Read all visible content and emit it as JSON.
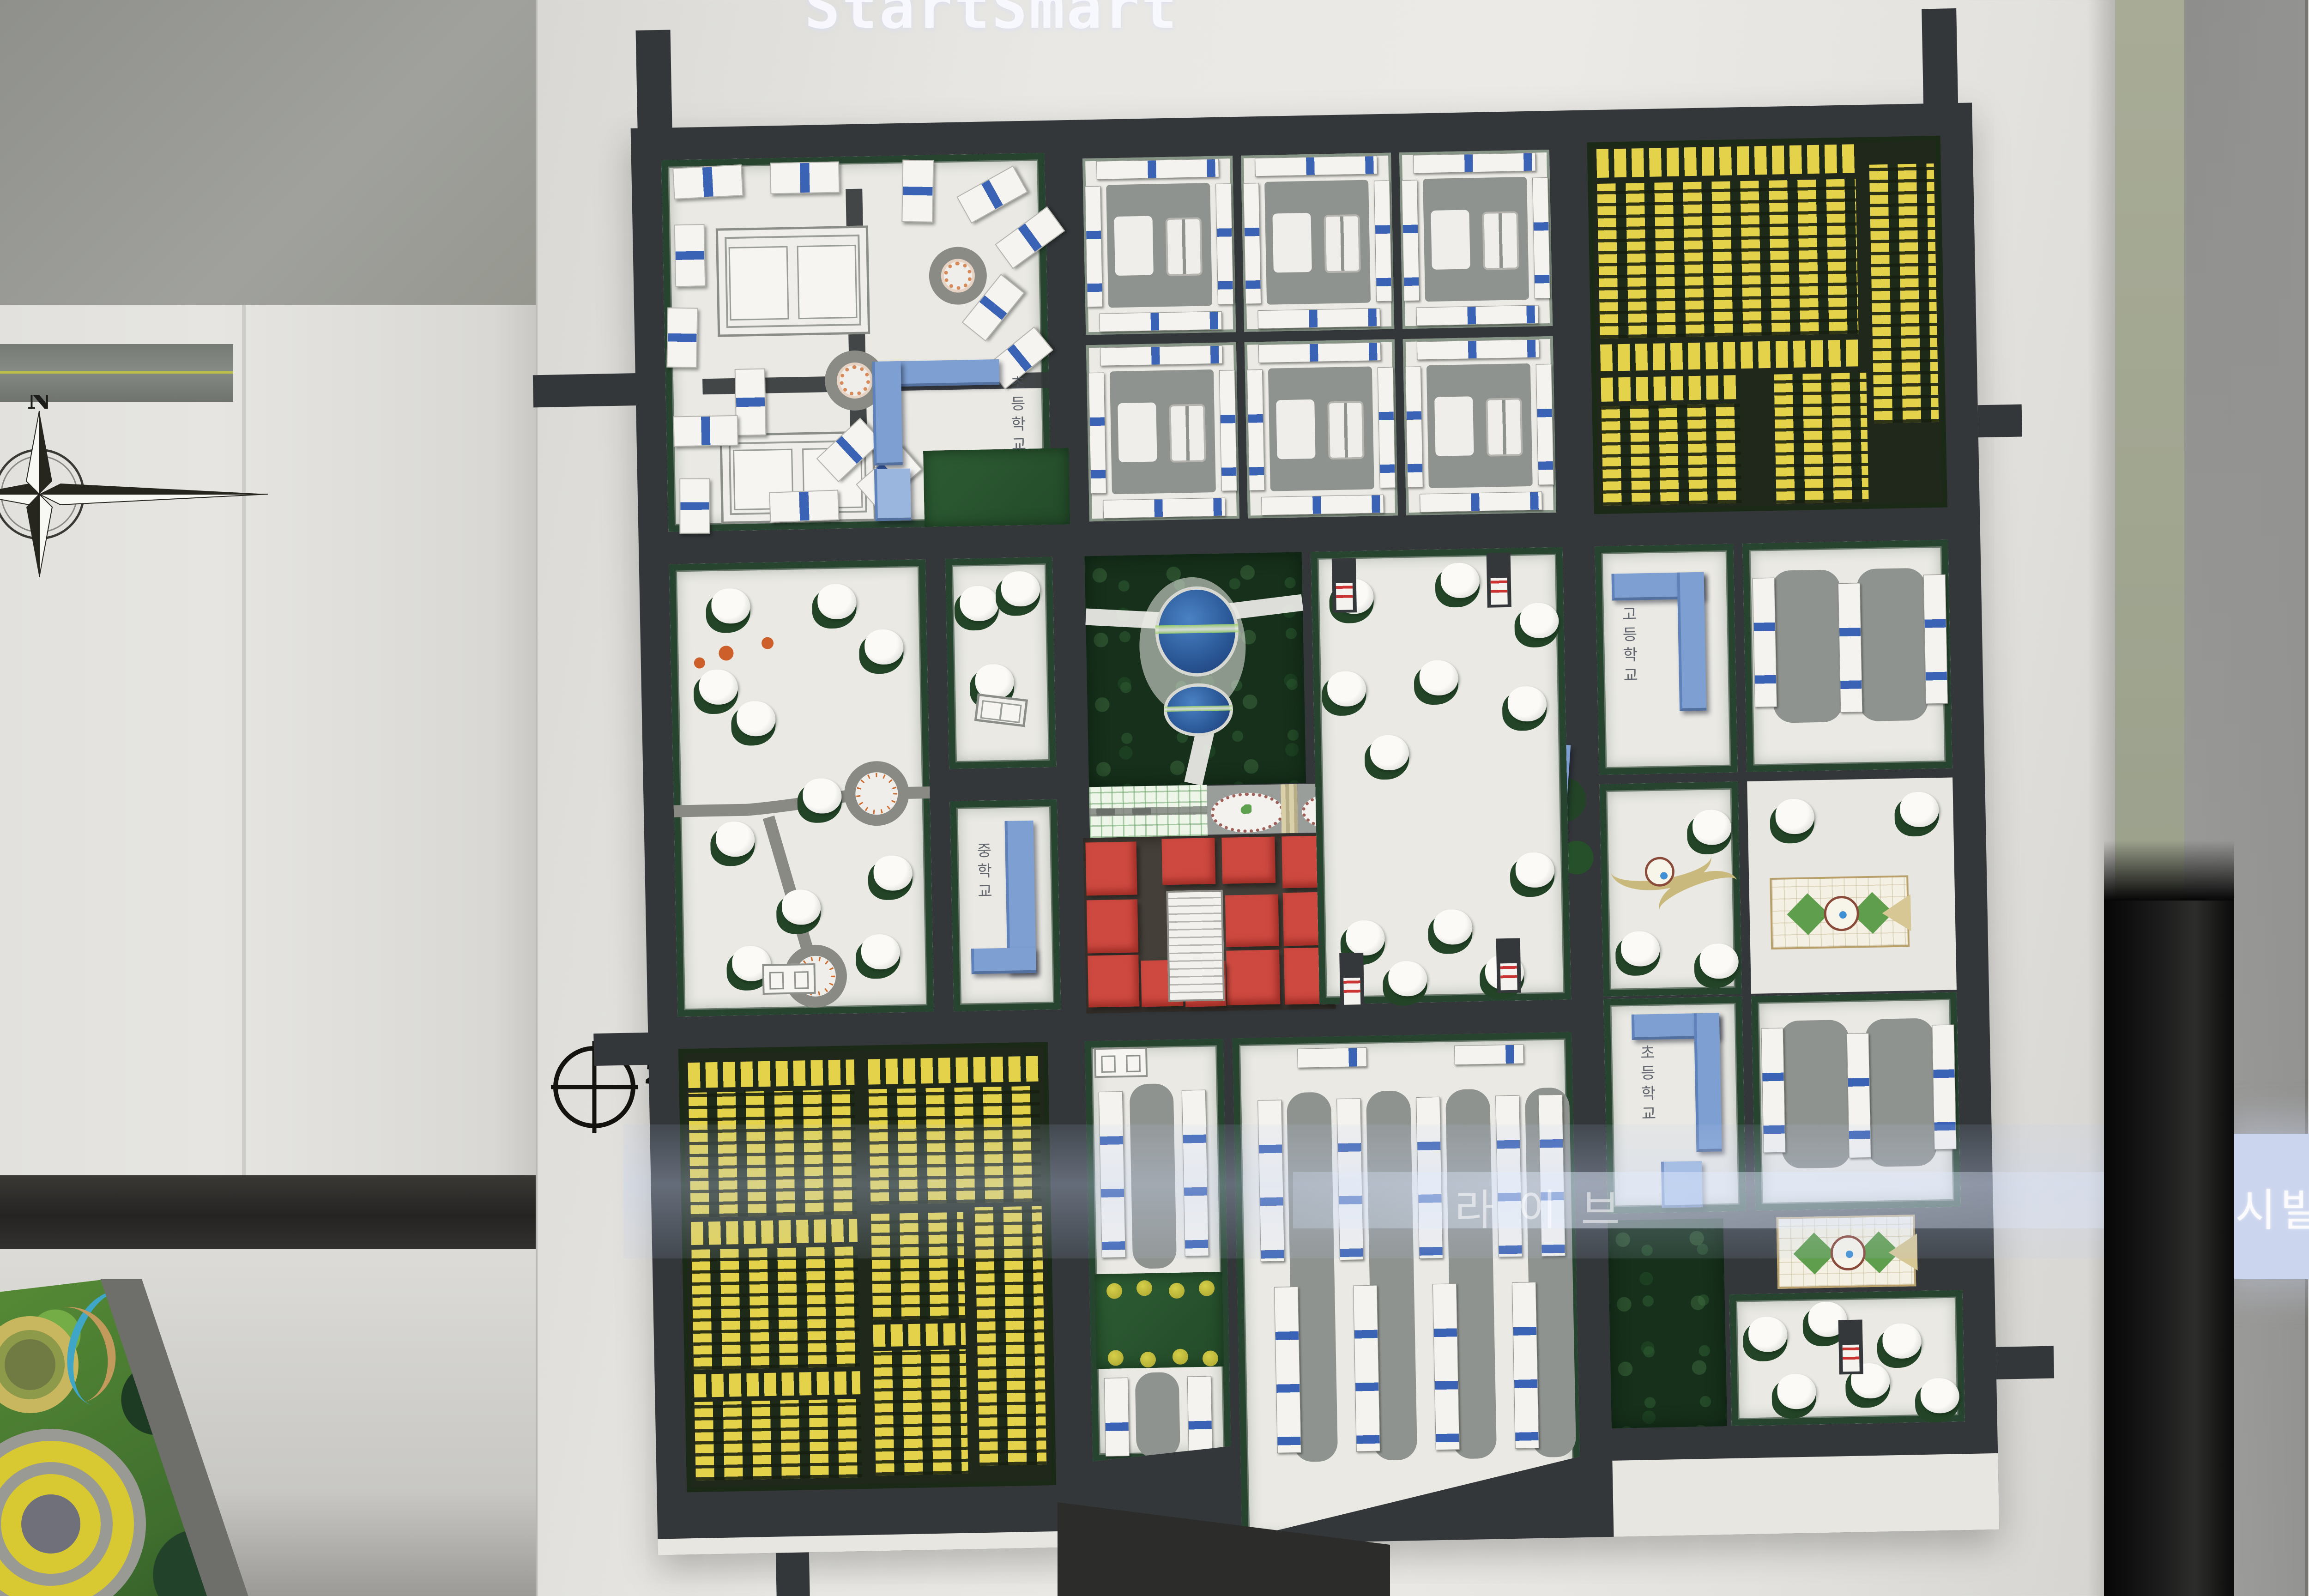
{
  "scene_type": "photograph of an urban-planning architectural scale model on a presentation board",
  "board": {
    "scale1": "1:2000",
    "scale2": "SCALE",
    "north": "N"
  },
  "left_board": {
    "north": "N"
  },
  "labels": {
    "a": "초등학교",
    "d": "중학교",
    "g": "고등학교",
    "o": "초등학교"
  },
  "reflections": {
    "top": "StartSmart",
    "ghost1": "Microso",
    "ghost2": "Office Ex",
    "band": "라이브",
    "screen": "시발표"
  },
  "colors": {
    "road": "#33373a",
    "board": "#e5e4e0",
    "hedge": "#22402a",
    "forest": "#16301b",
    "yellow": "#e4d24b",
    "red": "#ce4a41",
    "blue_building": "#7d9fd2",
    "blue_stripe": "#3b63b5",
    "gray_pad": "#8f938f",
    "white_building": "#f4f3ef",
    "pond": "#2e5fa3",
    "projection": "#ccd5ee"
  }
}
